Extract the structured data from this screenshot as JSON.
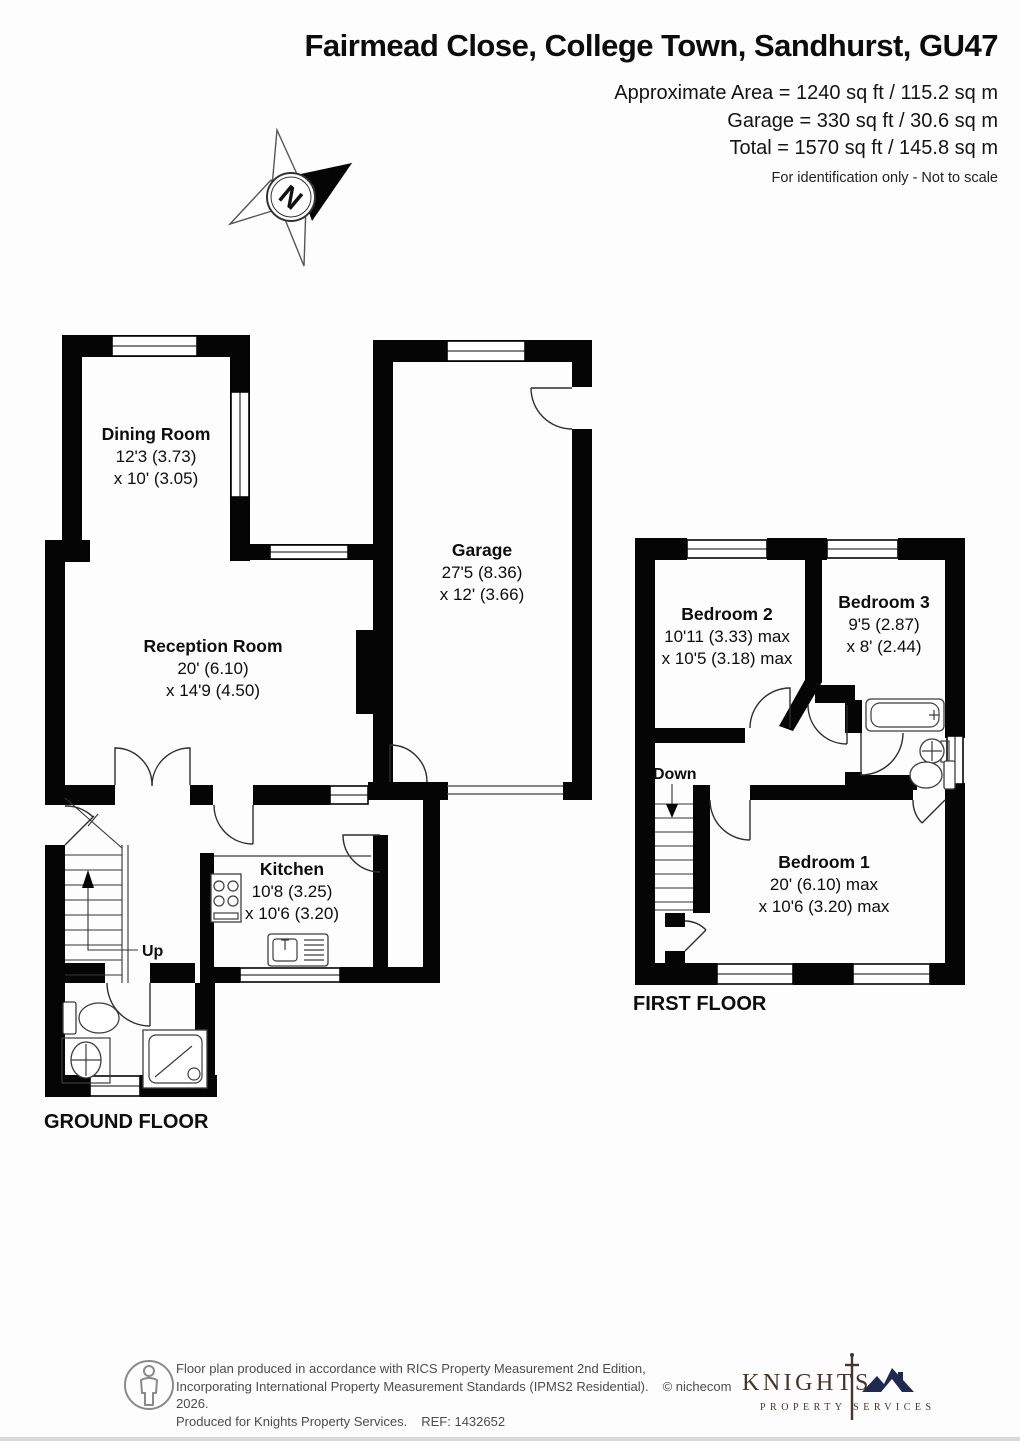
{
  "header": {
    "title": "Fairmead Close, College Town, Sandhurst, GU47",
    "area_line1": "Approximate Area = 1240 sq ft / 115.2 sq m",
    "area_line2": "Garage = 330 sq ft / 30.6 sq m",
    "area_line3": "Total = 1570 sq ft / 145.8 sq m",
    "disclaimer": "For identification only - Not to scale"
  },
  "compass": {
    "north_label": "N"
  },
  "floors": {
    "ground": {
      "label": "GROUND FLOOR",
      "stairs_label": "Up",
      "rooms": {
        "dining": {
          "name": "Dining Room",
          "dim1": "12'3 (3.73)",
          "dim2": "x 10' (3.05)"
        },
        "reception": {
          "name": "Reception Room",
          "dim1": "20' (6.10)",
          "dim2": "x 14'9 (4.50)"
        },
        "kitchen": {
          "name": "Kitchen",
          "dim1": "10'8 (3.25)",
          "dim2": "x 10'6 (3.20)"
        },
        "garage": {
          "name": "Garage",
          "dim1": "27'5 (8.36)",
          "dim2": "x 12' (3.66)"
        }
      }
    },
    "first": {
      "label": "FIRST FLOOR",
      "stairs_label": "Down",
      "rooms": {
        "bedroom1": {
          "name": "Bedroom 1",
          "dim1": "20' (6.10) max",
          "dim2": "x 10'6 (3.20) max"
        },
        "bedroom2": {
          "name": "Bedroom 2",
          "dim1": "10'11 (3.33) max",
          "dim2": "x 10'5 (3.18) max"
        },
        "bedroom3": {
          "name": "Bedroom 3",
          "dim1": "9'5 (2.87)",
          "dim2": "x 8' (2.44)"
        }
      }
    }
  },
  "footer": {
    "line1": "Floor plan produced in accordance with RICS Property Measurement 2nd Edition,",
    "line2": "Incorporating International Property Measurement Standards (IPMS2 Residential).",
    "copyright": "© nichecom 2026.",
    "line3": "Produced for Knights Property Services.",
    "ref": "REF: 1432652",
    "logo": {
      "name": "KNIGHTS",
      "tagline": "PROPERTY SERVICES"
    }
  },
  "colors": {
    "wall": "#050505",
    "logo_text": "#4a3328",
    "logo_roof": "#1e2a52"
  }
}
